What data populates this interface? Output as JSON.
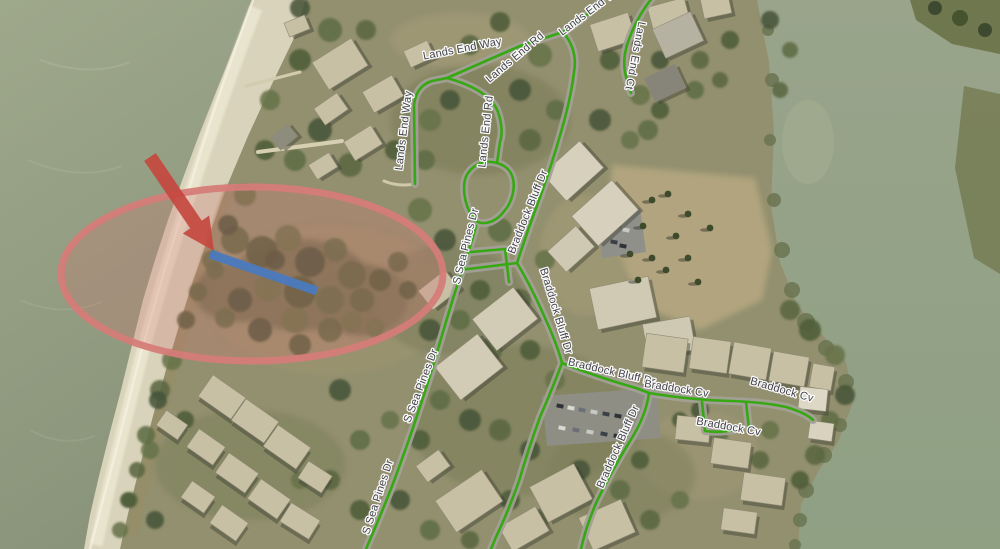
{
  "map": {
    "type": "aerial-imagery-with-street-overlay",
    "street_labels": [
      {
        "text": "Lands End Way"
      },
      {
        "text": "Lands End Way"
      },
      {
        "text": "Lands End Way"
      },
      {
        "text": "Lands End Rd"
      },
      {
        "text": "Lands End Rd"
      },
      {
        "text": "Lands End Ct"
      },
      {
        "text": "S Sea Pines Dr"
      },
      {
        "text": "S Sea Pines Dr"
      },
      {
        "text": "S Sea Pines Dr"
      },
      {
        "text": "Braddock Bluff Dr"
      },
      {
        "text": "Braddock Bluff Dr"
      },
      {
        "text": "Braddock Bluff Dr"
      },
      {
        "text": "Braddock Bluff Dr"
      },
      {
        "text": "Braddock Cv"
      },
      {
        "text": "Braddock Cv"
      },
      {
        "text": "Braddock Cv"
      }
    ],
    "roads": {
      "color": "#36a812"
    },
    "labels_style": {
      "color": "#3e3e49",
      "halo": "#ffffff"
    },
    "annotations": {
      "ellipse": {
        "stroke": "#d57c78",
        "fill": "#cf7270",
        "fill_opacity": "0.28"
      },
      "arrow": {
        "fill": "#c4483f"
      },
      "blue_line": {
        "stroke": "#4a7abf"
      }
    }
  }
}
